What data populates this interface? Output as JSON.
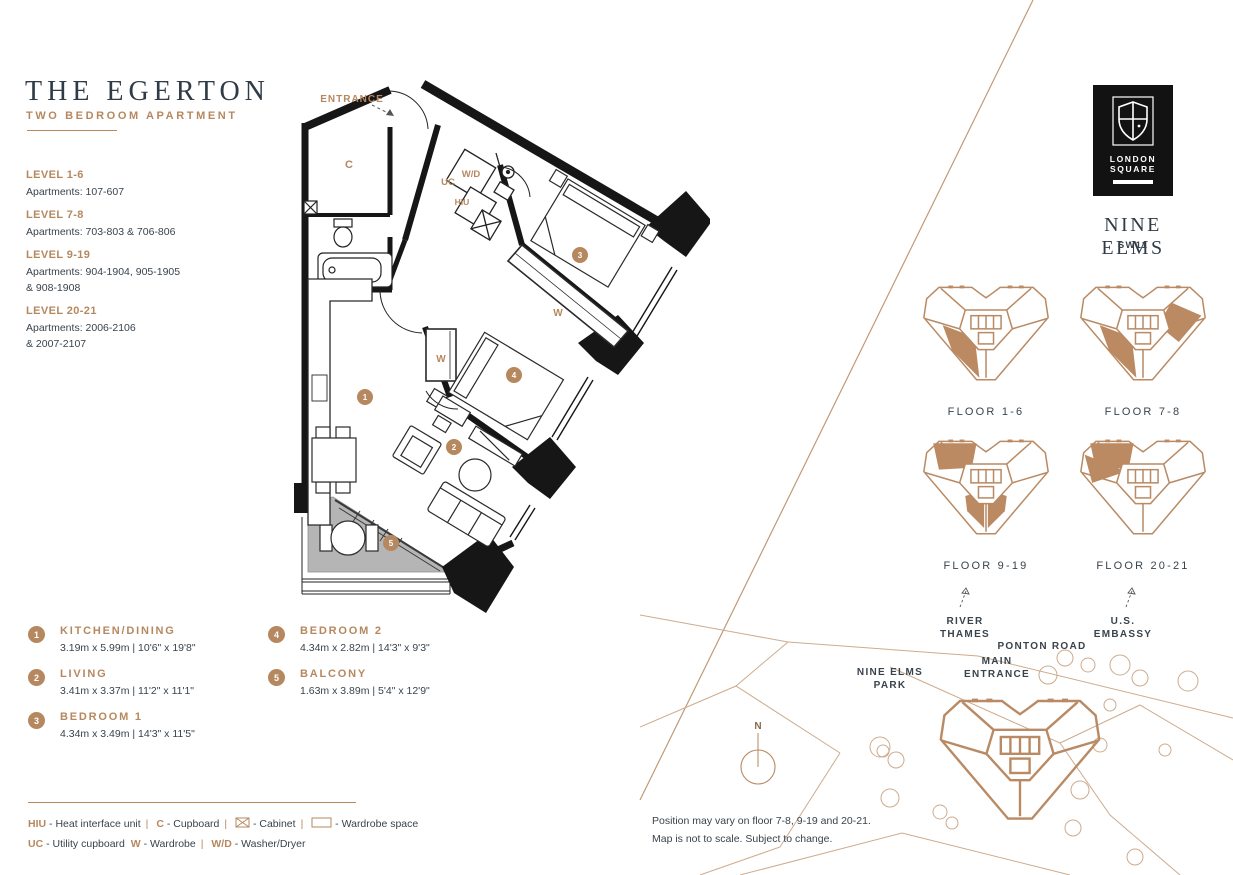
{
  "header": {
    "title": "THE EGERTON",
    "subtitle": "TWO BEDROOM APARTMENT"
  },
  "levels": [
    {
      "label": "LEVEL 1-6",
      "apartments": "Apartments: 107-607"
    },
    {
      "label": "LEVEL 7-8",
      "apartments": "Apartments: 703-803 & 706-806"
    },
    {
      "label": "LEVEL 9-19",
      "apartments": "Apartments: 904-1904, 905-1905",
      "apartments2": "& 908-1908"
    },
    {
      "label": "LEVEL 20-21",
      "apartments": "Apartments: 2006-2106",
      "apartments2": "& 2007-2107"
    }
  ],
  "rooms": [
    {
      "num": "1",
      "name": "KITCHEN/DINING",
      "dims": "3.19m x 5.99m | 10'6\" x 19'8\""
    },
    {
      "num": "2",
      "name": "LIVING",
      "dims": "3.41m x 3.37m | 11'2\" x 11'1\""
    },
    {
      "num": "3",
      "name": "BEDROOM 1",
      "dims": "4.34m x 3.49m | 14'3\" x 11'5\""
    },
    {
      "num": "4",
      "name": "BEDROOM 2",
      "dims": "4.34m x 2.82m | 14'3\" x 9'3\""
    },
    {
      "num": "5",
      "name": "BALCONY",
      "dims": "1.63m x 3.89m | 5'4\" x 12'9\""
    }
  ],
  "plan": {
    "entrance": "ENTRANCE",
    "cupboard": "C",
    "washer_dryer": "W/D",
    "utility_cupboard": "UC",
    "hiu": "HIU",
    "wardrobe1": "W",
    "wardrobe2": "W",
    "n1": "1",
    "n2": "2",
    "n3": "3",
    "n4": "4",
    "n5": "5"
  },
  "key": {
    "dash": "-",
    "sep": "|",
    "line1": [
      {
        "abbr": "HIU",
        "desc": "Heat interface unit"
      },
      {
        "abbr": "C",
        "desc": "Cupboard"
      },
      {
        "abbr": "",
        "desc": "Cabinet"
      },
      {
        "abbr": "",
        "desc": "Wardrobe space"
      }
    ],
    "line2": [
      {
        "abbr": "UC",
        "desc": "Utility cupboard"
      },
      {
        "abbr": "W",
        "desc": "Wardrobe"
      },
      {
        "abbr": "W/D",
        "desc": "Washer/Dryer"
      }
    ]
  },
  "brand": {
    "name_line1": "LONDON",
    "name_line2": "SQUARE",
    "location": "NINE ELMS",
    "postcode": "SW11"
  },
  "floor_keys": [
    {
      "label": "FLOOR 1-6",
      "zones": [
        "bottom-left"
      ]
    },
    {
      "label": "FLOOR 7-8",
      "zones": [
        "bottom-left",
        "right"
      ]
    },
    {
      "label": "FLOOR 9-19",
      "zones": [
        "top-left",
        "bottom-center-left",
        "bottom-center-right"
      ]
    },
    {
      "label": "FLOOR 20-21",
      "zones": [
        "top-left",
        "left-wedge"
      ]
    }
  ],
  "map": {
    "compass": "N",
    "river_l1": "RIVER",
    "river_l2": "THAMES",
    "embassy_l1": "U.S.",
    "embassy_l2": "EMBASSY",
    "road": "PONTON ROAD",
    "entrance_l1": "MAIN",
    "entrance_l2": "ENTRANCE",
    "park_l1": "NINE ELMS",
    "park_l2": "PARK"
  },
  "notes": {
    "line1": "Position may vary on floor 7-8, 9-19 and 20-21.",
    "line2": "Map is not to scale. Subject to change."
  },
  "colors": {
    "accent": "#b6885f",
    "dark": "#333e48",
    "wall": "#161616",
    "balcony_gray": "#b5b5b5"
  }
}
